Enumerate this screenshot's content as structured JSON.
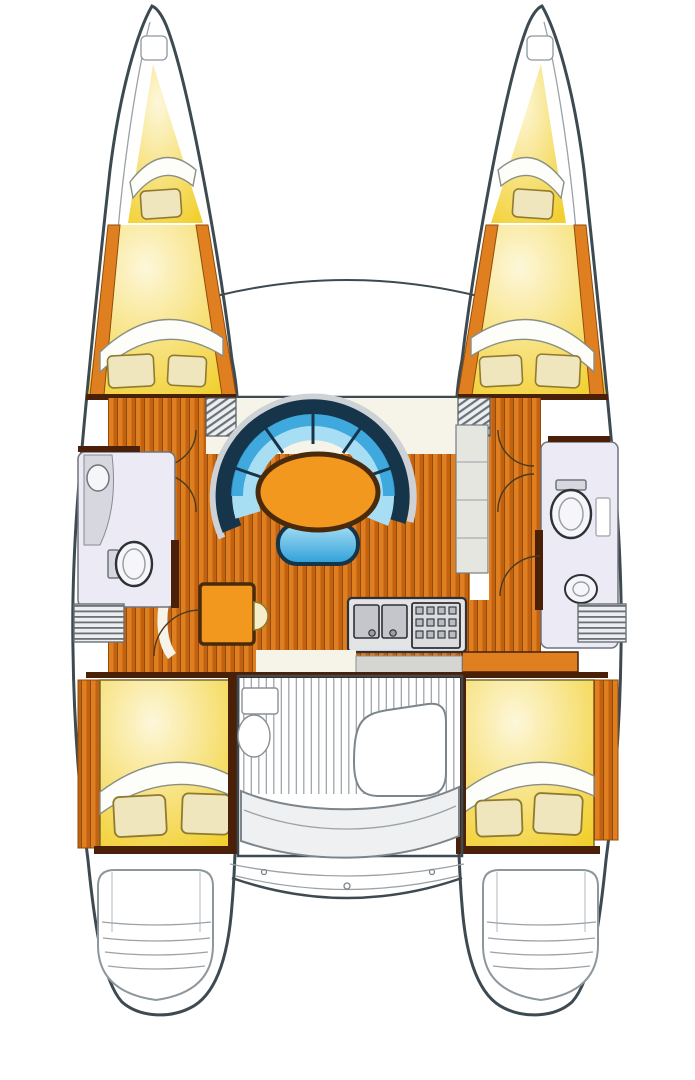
{
  "meta": {
    "diagram_type": "catamaran-interior-floorplan",
    "view": "top-down",
    "text_visible": false,
    "hulls": 2,
    "cabins": 4,
    "forepeak_berths": 2,
    "heads": 2
  },
  "colors": {
    "hullOutline": "#3d4a51",
    "sheerLine": "#a9b1b5",
    "deckWhite": "#ffffff",
    "woodOrange": "#e07f1f",
    "woodOrangeDark": "#c26110",
    "woodLine": "#8f4d0d",
    "wallBrown": "#4a2008",
    "cabinYellow": "#f2cf2d",
    "cabinYellowPale": "#fdf7da",
    "sheetWhite": "#fdfdfa",
    "sheetEdge": "#8a8f84",
    "pillowCream": "#efe6bd",
    "pillowEdge": "#8f7a30",
    "sofaNavy": "#16344a",
    "sofaBlue": "#2da0d8",
    "sofaBlueLight": "#a8def4",
    "sofaRim": "#cdd2d6",
    "tableOrange": "#f2981e",
    "tableEdge": "#4a2a0c",
    "bathFloor": "#eceaf4",
    "fixtureWhite": "#f6f6fa",
    "fixtureGray": "#d7d7df",
    "fixtureLine": "#70757c",
    "galleyGray": "#e3e4e6",
    "galleySteel": "#c4c6cc",
    "counterCream": "#f6f3e8",
    "cockpitSlat": "#97a0a6",
    "benchGray": "#eef0f1",
    "seatCream": "#f6eec8",
    "stepHatch": "#6a7278",
    "cabinetGray": "#e6e6e0",
    "stepBase": "#eceef0"
  }
}
